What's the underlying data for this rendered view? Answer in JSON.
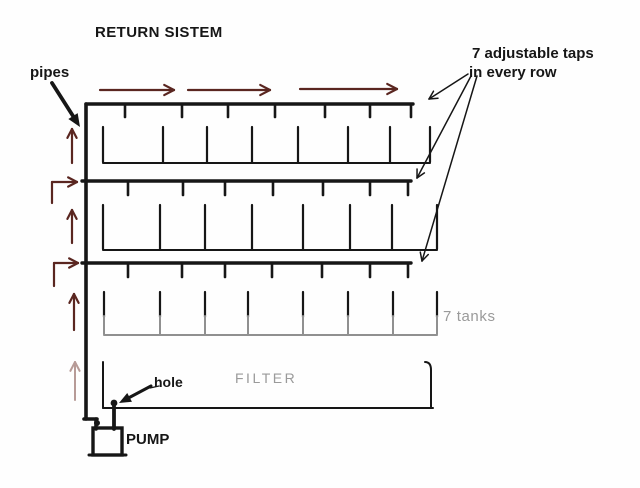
{
  "title": "RETURN SISTEM",
  "labels": {
    "pipes": "pipes",
    "taps_line1": "7 adjustable taps",
    "taps_line2": "in every row",
    "tanks": "7 tanks",
    "filter": "FILTER",
    "hole": "hole",
    "pump": "PUMP"
  },
  "colors": {
    "ink": "#161616",
    "flow_arrow": "#5a2620",
    "flow_arrow_faded": "#b79b97",
    "muted_text": "#9a9a9a",
    "muted_line": "#909090",
    "background": "#fefefe"
  },
  "diagram": {
    "main_pipe": {
      "x": 86,
      "y_top": 104,
      "y_bottom": 419
    },
    "rows": [
      {
        "pipe_y": 104,
        "pipe_x1": 86,
        "pipe_x2": 413,
        "tap_xs": [
          125,
          182,
          228,
          275,
          325,
          370,
          411
        ],
        "tap_len": 13,
        "divider_xs": [
          103,
          163,
          207,
          252,
          298,
          348,
          390,
          430
        ],
        "divider_y1": 127,
        "divider_y2": 162,
        "bottom_x2": 430,
        "bottom_gray": false
      },
      {
        "pipe_y": 181,
        "pipe_x1": 82,
        "pipe_x2": 411,
        "tap_xs": [
          128,
          183,
          225,
          273,
          323,
          370,
          408
        ],
        "tap_len": 14,
        "divider_xs": [
          103,
          160,
          205,
          252,
          303,
          350,
          392,
          437
        ],
        "divider_y1": 205,
        "divider_y2": 249,
        "bottom_x2": 437,
        "bottom_gray": false
      },
      {
        "pipe_y": 263,
        "pipe_x1": 82,
        "pipe_x2": 411,
        "tap_xs": [
          128,
          182,
          225,
          272,
          322,
          370,
          408
        ],
        "tap_len": 14,
        "divider_xs": [
          104,
          160,
          205,
          248,
          303,
          348,
          393,
          437
        ],
        "divider_y1": 292,
        "divider_y2": 334,
        "bottom_x2": 437,
        "bottom_gray": true
      }
    ],
    "flow_arrows_top": [
      [
        100,
        174,
        90
      ],
      [
        188,
        270,
        90
      ],
      [
        300,
        397,
        89
      ]
    ],
    "flow_arrows_up": [
      [
        72,
        163,
        129
      ],
      [
        72,
        243,
        210
      ],
      [
        74,
        330,
        294
      ]
    ],
    "flow_arrow_up_faded": [
      75,
      400,
      362
    ],
    "elbow_arrows": [
      [
        52,
        203,
        182,
        77
      ],
      [
        54,
        286,
        263,
        78
      ]
    ],
    "taps_pointer_lines": [
      [
        468,
        74,
        429,
        99
      ],
      [
        471,
        76,
        417,
        178
      ],
      [
        477,
        76,
        422,
        261
      ]
    ],
    "pipes_arrow": {
      "x1": 52,
      "y1": 83,
      "x2": 80,
      "y2": 127
    },
    "hole_arrow": {
      "x1": 151,
      "y1": 386,
      "x2": 119,
      "y2": 403
    },
    "hole_arrow_leader": [
      159,
      386,
      150,
      388
    ],
    "filter_box": {
      "x1": 103,
      "x2": 433,
      "y_top": 362,
      "y_bottom": 408,
      "right_x": 431
    },
    "pump": {
      "x": 93,
      "y": 428,
      "w": 29,
      "h": 27
    },
    "hole_pipe": {
      "x": 114,
      "y1": 403,
      "y2": 429
    },
    "hole_dot": [
      114,
      403
    ],
    "pump_inlet": {
      "hx1": 84,
      "hx2": 97,
      "hy": 419,
      "vx": 96,
      "vy2": 429,
      "dot": [
        97,
        423
      ]
    }
  }
}
